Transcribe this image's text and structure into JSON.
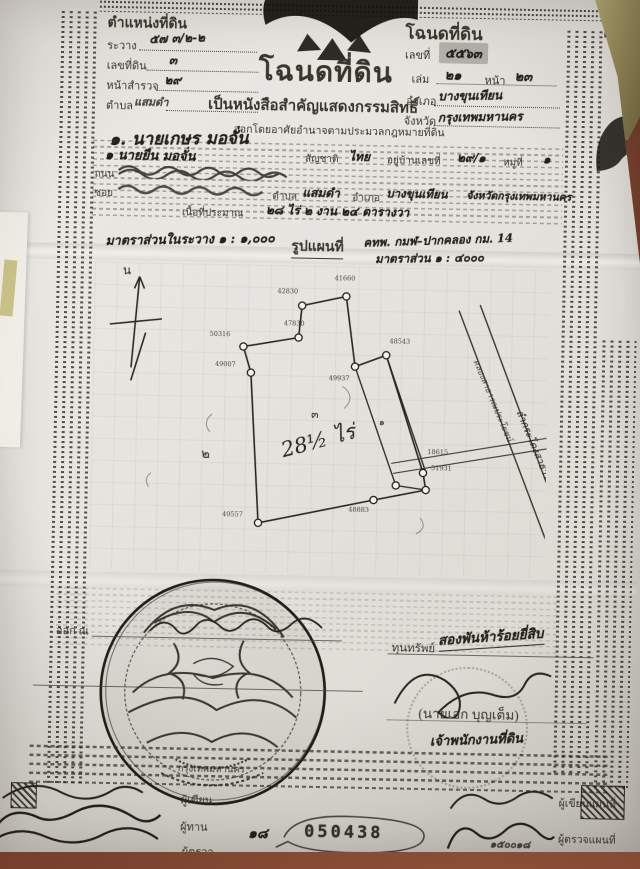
{
  "deed": {
    "position_block": {
      "title": "ตำแหน่งที่ดิน",
      "rawang_label": "ระวาง",
      "rawang_value": "๕๗ ๓/๒-๒",
      "land_no_label": "เลขที่ดิน",
      "land_no_value": "๓",
      "survey_label": "หน้าสำรวจ",
      "survey_value": "๒๙",
      "tambon_label": "ตำบล",
      "tambon_value": "แสมดำ"
    },
    "number_block": {
      "title": "โฉนดที่ดิน",
      "no_label": "เลขที่",
      "no_value": "๕๕๖๓",
      "volume_label": "เล่ม",
      "volume_value": "๒๑",
      "page_label": "หน้า",
      "page_value": "๒๓",
      "amphoe_label": "อำเภอ",
      "amphoe_value": "บางขุนเทียน",
      "province_label": "จังหวัด",
      "province_value": "กรุงเทพมหานคร"
    },
    "title_block": {
      "title": "โฉนดที่ดิน",
      "subtitle": "เป็นหนังสือสำคัญแสดงกรรมสิทธิ์",
      "authority": "ออกโดยอาศัยอำนาจตามประมวลกฎหมายที่ดิน"
    },
    "owner_line": "๑. นายเกษร มอจั่น",
    "form": {
      "given_value": "๑ นายยืน มอจั่น",
      "nationality_label": "สัญชาติ",
      "nationality_value": "ไทย",
      "address_label": "อยู่บ้านเลขที่",
      "address_value": "๒๙/๑",
      "moo_label": "หมู่ที่",
      "moo_value": "๑",
      "road_label": "ถนน",
      "soi_label": "ซอย",
      "tambon_label": "ตำบล",
      "tambon_value": "แสมดำ",
      "amphoe_label": "อำเภอ",
      "amphoe_value": "บางขุนเทียน",
      "province_value": "จังหวัดกรุงเทพมหานคร",
      "area_label": "เนื้อที่ประมาณ",
      "area_value": "๒๘ ไร่ ๒ งาน ๒๔ ตารางวา"
    },
    "scale": {
      "in_sheet": "มาตราส่วนในระวาง ๑ : ๑,๐๐๐",
      "map_label": "รูปแผนที่",
      "sheet_ref": "คทพ. กมฬ–ปากคลอง กม. 14",
      "map_scale": "มาตราส่วน ๑ : ๔๐๐๐"
    },
    "map": {
      "north": "น",
      "area_note": "28½ ไร่",
      "parcels": [
        "๑",
        "๒",
        "๓"
      ],
      "vertices": [
        "50316",
        "47830",
        "42830",
        "41660",
        "49937",
        "48543",
        "49007",
        "48883",
        "51931",
        "18615",
        "49557"
      ],
      "canal_text": "ลำกระโดงสาธารณประโยชน์",
      "canal_text2": "คลองสาธารณประโยชน์"
    },
    "issue": {
      "issued_label": "ออก ณ",
      "fee_label": "ทุนทรัพย์",
      "fee_value": "สองพันห้าร้อยยี่สิบ",
      "officer_name": "(นายเอก บุญเต็ม)",
      "officer_title": "เจ้าพนักงานที่ดิน",
      "seal_caption": "กรุงเทพมหานคร"
    },
    "footer": {
      "writer": "ผู้เขียน",
      "proof": "ผู้ทาน",
      "checker": "ผู้ตรวจ",
      "serial_prefix": "๑๘",
      "serial": "050438",
      "map_writer": "ผู้เขียนแผนที่",
      "map_checker": "ผู้ตรวจแผนที่",
      "right_note": "๑๕๐๐๑๘"
    }
  }
}
